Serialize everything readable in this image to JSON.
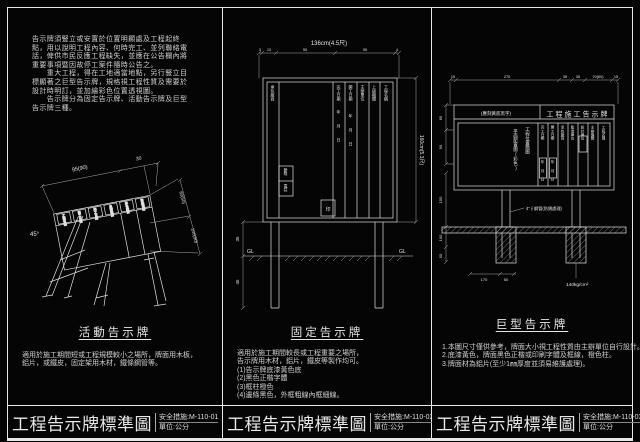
{
  "titleblocks": [
    {
      "title": "工程告示牌標準圖",
      "code": "安全措施:M-110-01",
      "unit": "單位:公分"
    },
    {
      "title": "工程告示牌標準圖",
      "code": "安全措施:M-110-02",
      "unit": "單位:公分"
    },
    {
      "title": "工程告示牌標準圖",
      "code": "安全措施:M-110-03",
      "unit": "單位:公分"
    }
  ],
  "panel1": {
    "intro_lines": [
      "告示牌須豎立或安置於位置明顯處及工程起終",
      "點，用以說明工程內容、何時完工、並列聯絡電",
      "話，俾供市民反應工程缺失，並應在公告欄內將",
      "重要事項暨因故停工案件隨時公告之。",
      "　　重大工程，得在工地適當地點，另行豎立目",
      "標顯著之巨型告示牌，規格視工程性質及需要於",
      "設計時明訂，並加繪彩色位置透視圖。",
      "　　告示牌分為固定告示牌、活動告示牌及巨型",
      "告示牌三種。"
    ],
    "caption": "活動告示牌",
    "notes_lines": [
      "適用於施工期間短或工程規模較小之場所，牌面用木板，",
      "鋁片，或鐵皮，固定架用木材，鐵條鋼管等。"
    ],
    "drawing": {
      "dim_main": "95(90)",
      "dim_ext": "30",
      "angle_label": "45°",
      "dim_r1": "60(50)",
      "dim_r2": "100(90)",
      "headers": [
        "工程名稱",
        "開工日期",
        "完工日期",
        "主辦機關",
        "承包廠商",
        "聯絡電話"
      ]
    }
  },
  "panel2": {
    "caption": "固定告示牌",
    "notes_lines": [
      "適用於施工期間較長或工程重要之場所，",
      "告示牌用木材，鋁片，鐵皮等製作均可。",
      "(1)告示牌底漆黃色底",
      "(2)黑色正楷字體",
      "(3)框柱橙色",
      "(4)邊條黑色，外框粗線內框細線。"
    ],
    "drawing": {
      "dim_top": "136cm(4.5尺)",
      "dim_top_segs": [
        "3",
        "13",
        "55",
        "55",
        "4"
      ],
      "dim_right": "160cm(5.3尺)",
      "dim_left_segs": [
        "35",
        "45"
      ],
      "gl_label": "GL",
      "col_headers": [
        "完工日期",
        "開工日期",
        "主辦單位",
        "上級機關",
        "工程名稱"
      ],
      "left_col_header": "承包廠商",
      "left_cells": [
        "聯絡",
        "電話"
      ],
      "date_chars": "年月日",
      "stamp": "印"
    }
  },
  "panel3": {
    "caption": "巨型告示牌",
    "notes_lines": [
      "1.本圖尺寸僅供參考，牌面大小視工程性質由主辦單位自行設計。",
      "2.底漆黃色，牌面黑色正楷或印刷字體及框線，橙色柱。",
      "3.牌面材為鋁片(至少1㎜厚度並須易維護處理)。"
    ],
    "drawing": {
      "dim_top_segs": [
        "15",
        "270",
        "35",
        "35",
        "70(60)",
        "15"
      ],
      "dim_left_top": [
        "65",
        "90"
      ],
      "dim_left_bottom": [
        "150",
        "100",
        "50"
      ],
      "dim_bottom": [
        "170",
        "50"
      ],
      "header_left": "(應刻黃底黑字)",
      "header_right": "工程施工告示牌",
      "big_cell_lines": [
        "工程位置簡圖",
        "平面配置圖(彩色)"
      ],
      "col_headers": [
        "完工日期",
        "開工日期",
        "承包廠商",
        "監造單位",
        "設計單位",
        "主辦機關",
        "工程名稱"
      ],
      "date_chars": "年月日",
      "pipe_note": "4\"∮鋼管(防銹處理)",
      "strength_note": "140kg/cm²",
      "gl_label": "GL"
    }
  }
}
